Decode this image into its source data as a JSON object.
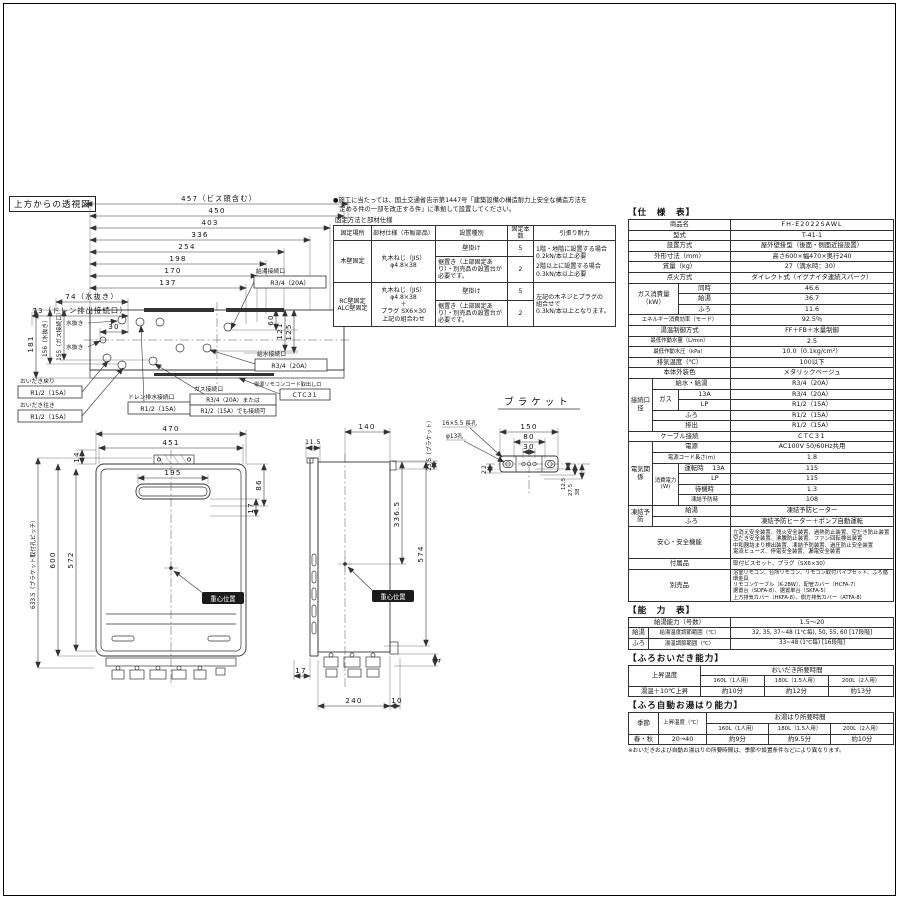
{
  "page": {
    "frame": true
  },
  "topview": {
    "title": "上方からの透視図",
    "dims": {
      "d457": "457（ビス頭含む）",
      "d450": "450",
      "d403": "403",
      "d336": "336",
      "d254": "254",
      "d198": "198",
      "d170": "170",
      "d137": "137",
      "d74": "74（水抜き）",
      "d73": "73（ドレン排出接続口）",
      "d30": "30",
      "d181": "181",
      "d156": "156（水抜き）",
      "d155": "155（ガス接続口）",
      "d60": "60",
      "d121": "121",
      "d125": "125"
    },
    "labels": {
      "hot_out": "給湯接続口",
      "hot_out_size": "R3/4（20A）",
      "water_in": "給水接続口",
      "water_in_size": "R3/4（20A）",
      "cord": "電源リモコンコード取出し口",
      "cord_size": "CTC31",
      "bath_return": "おいだき戻り",
      "bath_return_size": "R1/2（15A）",
      "bath_go": "おいだき往き",
      "bath_go_size": "R1/2（15A）",
      "drain": "ドレン排水接続口",
      "drain_size": "R1/2（15A）",
      "gas": "ガス接続口",
      "gas_size1": "R3/4（20A）または",
      "gas_size2": "R1/2（15A）でも接続可",
      "mizunuki1": "水抜き",
      "mizunuki2": "水抜き"
    }
  },
  "fixing": {
    "note1": "●施工に当たっては、国土交通省告示第1447号「建築設備の構造耐力上安全な構造方法を",
    "note2": "　定める件の一部を改正する件」に準拠して設置してください。",
    "caption": "固定方法と部材仕様",
    "h_place": "固定場所",
    "h_part": "部材仕様（市販部品）",
    "h_type": "設置種別",
    "h_num": "固定本数",
    "h_pull": "引張り耐力",
    "wood_place": "木壁固定",
    "wood_part1": "丸木ねじ（JIS）",
    "wood_part2": "φ4.8×38",
    "wood_type1": "壁掛け",
    "wood_num1": "5",
    "wood_type2": "据置き（上部固定あり）・別売品の設置台が必要です。",
    "wood_num2": "2",
    "wood_pull1": "1階・地階に設置する場合",
    "wood_pull1b": "0.2kN/本以上必要",
    "wood_pull2": "2階以上に設置する場合",
    "wood_pull2b": "0.3kN/本以上必要",
    "rc_place1": "RC壁固定",
    "rc_place2": "ALC壁固定",
    "rc_part1": "丸木ねじ（JIS）",
    "rc_part2": "φ4.8×38",
    "rc_part3": "＋",
    "rc_part4": "プラグ SX6×30",
    "rc_part5": "上記の組合わせ",
    "rc_type1": "壁掛け",
    "rc_num1": "5",
    "rc_type2": "据置き（上部固定あり）・別売品の設置台が必要です。",
    "rc_num2": "2",
    "rc_pull1": "左記の木ネジとプラグの",
    "rc_pull2": "組合せで",
    "rc_pull3": "0.3kN/本以上となります。"
  },
  "spec": {
    "title": "【仕　様　表】",
    "product_label": "商品名",
    "product": "FH-E2022SAWL",
    "model_label": "型式",
    "model": "T-41-1",
    "install_label": "設置方式",
    "install": "屋外壁掛型（後面・側面近接設置）",
    "dims_label": "外形寸法（mm）",
    "dims": "高さ600×幅470×奥行240",
    "weight_label": "質量（kg）",
    "weight": "27（満水時：30）",
    "ignition_label": "点火方式",
    "ignition": "ダイレクト式（イグナイタ連続スパーク）",
    "gas_label": "ガス消費量（kW）",
    "gas_rows": [
      [
        "同時",
        "46.6"
      ],
      [
        "給湯",
        "36.7"
      ],
      [
        "ふろ",
        "11.6"
      ]
    ],
    "eff_label": "エネルギー消費効率（モード）",
    "eff": "92.5％",
    "ctrl_label": "湯温制御方式",
    "ctrl": "FF＋FB＋水量制御",
    "minflow_label": "最低作動水量（L/min）",
    "minflow": "2.5",
    "minpress_label": "最低作動水圧（kPa）",
    "minpress": "10.0（0.1kg/cm²）",
    "exhaust_label": "排気温度（℃）",
    "exhaust": "100以下",
    "color_label": "本体外装色",
    "color": "メタリックベージュ",
    "conn_label": "接続口径",
    "conn_water_label": "給水・給湯",
    "conn_water": "R3/4（20A）",
    "conn_gas_label": "ガス",
    "conn_gas13_label": "13A",
    "conn_gas13": "R3/4（20A）",
    "conn_gaslp_label": "LP",
    "conn_gaslp": "R1/2（15A）",
    "conn_furo_label": "ふろ",
    "conn_furo": "R1/2（15A）",
    "conn_drain_label": "排出",
    "conn_drain": "R1/2（15A）",
    "cable_label": "ケーブル接続",
    "cable": "CTC31",
    "elec_label": "電気関係",
    "power_label": "電源",
    "power": "AC100V 50/60Hz共用",
    "cord_label": "電源コード長さ(m)",
    "cord": "1.8",
    "wattage_label": "消費電力(W)",
    "watt_run_label": "運転時",
    "watt_13a_label": "13A",
    "watt_13a": "115",
    "watt_lp_label": "LP",
    "watt_lp": "115",
    "watt_standby_label": "待機時",
    "watt_standby": "1.3",
    "watt_frost_label": "凍結予防時",
    "watt_frost": "108",
    "frost_label": "凍結予防",
    "frost_hot_label": "給湯",
    "frost_hot": "凍結予防ヒーター",
    "frost_furo_label": "ふろ",
    "frost_furo": "凍結予防ヒーター＋ポンプ自動運転",
    "safety_label": "安心・安全機能",
    "safety_lines": [
      "立消え安全装置、残火安全装置、過熱防止装置、空だき防止装置",
      "空だき安全装置、沸騰防止装置、ファン回転検出装置",
      "中和器詰まり検出装置、凍結予防装置、過圧防止安全装置",
      "電流ヒューズ、停電安全装置、漏電安全装置"
    ],
    "accessory_label": "付属品",
    "accessory": "取付ビスセット、プラグ（SX6×30）",
    "optional_label": "別売品",
    "optional_lines": [
      "浴室リモコン、台所リモコン、リモコン取付パイプセット、ふろ循環金具",
      "リモコンケーブル（K-2BW）、配管カバー（HCFA-7）",
      "据置台（SDFA-8）、据置単台（SKFA-5）",
      "上方排気カバー（HKFA-8）、側方排気カバー（ATFA-8）"
    ]
  },
  "capacity": {
    "title": "【能　力　表】",
    "r1_label": "給湯能力（号数）",
    "r1_value": "1.5～20",
    "hot_label": "給湯",
    "hot_range_label": "給湯温度調節範囲（℃）",
    "hot_range": "32, 35, 37~48 (1℃毎), 50, 55, 60 [17段階]",
    "furo_label": "ふろ",
    "furo_range_label": "湯温調節範囲（℃）",
    "furo_range": "33~48 (1℃毎) [16段階]"
  },
  "oidaki": {
    "title": "【ふろおいだき能力】",
    "col_rise": "上昇温度",
    "col_time": "おいだき所要時間",
    "sizes": [
      "160L（1人用）",
      "180L（1.5人用）",
      "200L（2人用）"
    ],
    "row_label": "湯温＋10℃上昇",
    "times": [
      "約10分",
      "約12分",
      "約13分"
    ]
  },
  "yuhari": {
    "title": "【ふろ自動お湯はり能力】",
    "col_season": "季節",
    "col_rise": "上昇温度（℃）",
    "col_time": "お湯はり所要時間",
    "sizes": [
      "160L（1人用）",
      "180L（1.5人用）",
      "200L（2人用）"
    ],
    "season": "春・秋",
    "rise": "20→40",
    "times": [
      "約9分",
      "約9.5分",
      "約10分"
    ],
    "note": "※おいだきおよび自動お湯はりの所要時間は、季節や設置条件などにより異なります。"
  },
  "front": {
    "d470": "470",
    "d451": "451",
    "d195": "195",
    "d14": "14",
    "d86": "86",
    "d17": "17",
    "d600": "600",
    "d572": "572",
    "d6335": "633.5（ブラケット取付孔ピッチ）",
    "cog": "重心位置"
  },
  "side": {
    "d115": "11.5",
    "d140": "140",
    "d235": "23.5（ブラケット）",
    "d3365": "336.5",
    "d574": "574",
    "d17": "17",
    "d240": "240",
    "d10": "10",
    "d4": "4",
    "cog": "重心位置"
  },
  "bracket": {
    "title": "ブラケット",
    "hole1": "16×5.5 長孔",
    "hole2": "φ13孔",
    "d150": "150",
    "d80": "80",
    "d30": "30",
    "d22": "22",
    "d125": "12.5",
    "d275": "27.5",
    "d38": "38"
  }
}
